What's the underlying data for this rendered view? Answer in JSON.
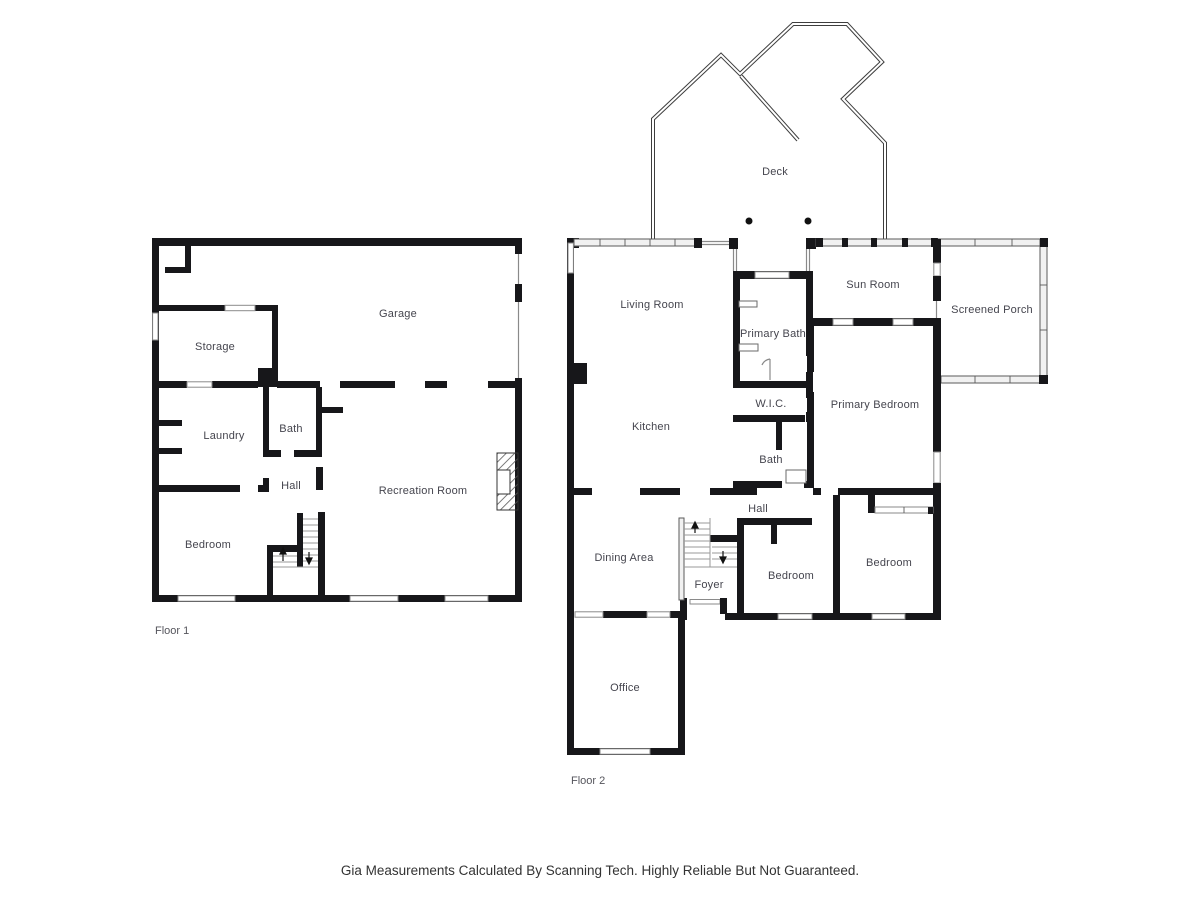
{
  "floor1": {
    "title": "Floor 1",
    "rooms": {
      "garage": "Garage",
      "storage": "Storage",
      "laundry": "Laundry",
      "bath": "Bath",
      "hall": "Hall",
      "recreation_room": "Recreation Room",
      "bedroom": "Bedroom"
    }
  },
  "floor2": {
    "title": "Floor 2",
    "rooms": {
      "deck": "Deck",
      "living_room": "Living Room",
      "primary_bath": "Primary Bath",
      "sun_room": "Sun Room",
      "screened_porch": "Screened Porch",
      "wic": "W.I.C.",
      "primary_bedroom": "Primary Bedroom",
      "kitchen": "Kitchen",
      "bath": "Bath",
      "hall": "Hall",
      "dining_area": "Dining Area",
      "foyer": "Foyer",
      "bedroom_1": "Bedroom",
      "bedroom_2": "Bedroom",
      "office": "Office"
    }
  },
  "caption": "Gia Measurements Calculated By Scanning Tech. Highly Reliable But Not Guaranteed.",
  "colors": {
    "wall": "#17171a",
    "window": "#8a8a8a",
    "screen_wall": "#f1f1f1",
    "label": "#45454e",
    "caption": "#333333",
    "background": "#ffffff"
  }
}
